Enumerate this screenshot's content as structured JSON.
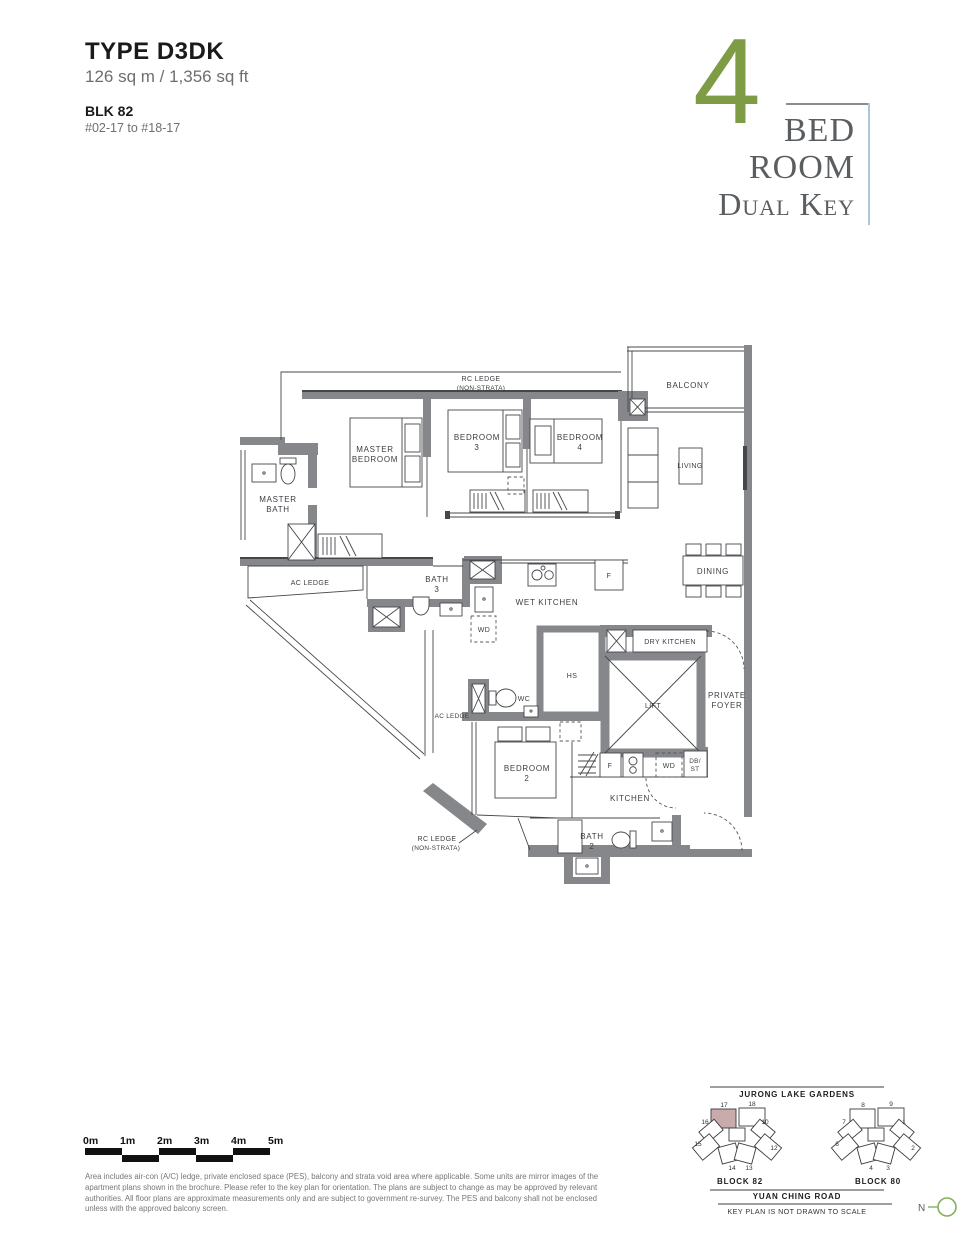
{
  "header": {
    "type_label": "TYPE D3DK",
    "area": "126 sq m / 1,356 sq ft",
    "block": "BLK 82",
    "levels": "#02-17 to #18-17"
  },
  "title": {
    "number": "4",
    "line1": "BED",
    "line2": "ROOM",
    "line3": "Dual Key"
  },
  "plan": {
    "labels": {
      "rc_top_1": "RC LEDGE",
      "rc_top_2": "(NON-STRATA)",
      "master_bed_1": "MASTER",
      "master_bed_2": "BEDROOM",
      "bed3_1": "BEDROOM",
      "bed3_2": "3",
      "bed4_1": "BEDROOM",
      "bed4_2": "4",
      "balcony": "BALCONY",
      "living": "LIVING",
      "master_bath_1": "MASTER",
      "master_bath_2": "BATH",
      "ac_left": "AC LEDGE",
      "bath3_1": "BATH",
      "bath3_2": "3",
      "wet_kitchen": "WET KITCHEN",
      "wd_top": "WD",
      "f_top": "F",
      "dining": "DINING",
      "dry_kitchen": "DRY KITCHEN",
      "hs": "HS",
      "wc": "WC",
      "ac_center": "AC LEDGE",
      "foyer_1": "PRIVATE",
      "foyer_2": "FOYER",
      "lift": "LIFT",
      "bed2_1": "BEDROOM",
      "bed2_2": "2",
      "f_bot": "F",
      "wd_bot": "WD",
      "db_1": "DB/",
      "db_2": "ST",
      "kitchen": "KITCHEN",
      "bath2_1": "BATH",
      "bath2_2": "2",
      "rc_bot_1": "RC LEDGE",
      "rc_bot_2": "(NON-STRATA)"
    }
  },
  "scale_bar": {
    "labels": [
      "0m",
      "1m",
      "2m",
      "3m",
      "4m",
      "5m"
    ]
  },
  "disclaimer": "Area includes air-con (A/C) ledge, private enclosed space (PES), balcony and strata void area where applicable. Some units are mirror images of the apartment plans shown in the brochure. Please refer to the key plan for orientation. The plans are subject to change as may be approved by relevant authorities. All floor plans are approximate measurements only and are subject to government re-survey. The PES and balcony shall not be enclosed unless with the approved balcony screen.",
  "key_plan": {
    "top_label": "JURONG LAKE GARDENS",
    "block82": "BLOCK 82",
    "block80": "BLOCK 80",
    "road": "YUAN CHING ROAD",
    "note": "KEY PLAN IS NOT DRAWN TO SCALE",
    "compass": "N",
    "block82_units": [
      "17",
      "18",
      "16",
      "10",
      "15",
      "12",
      "14",
      "13"
    ],
    "block80_units": [
      "8",
      "9",
      "7",
      "1",
      "6",
      "2",
      "4",
      "3"
    ]
  }
}
